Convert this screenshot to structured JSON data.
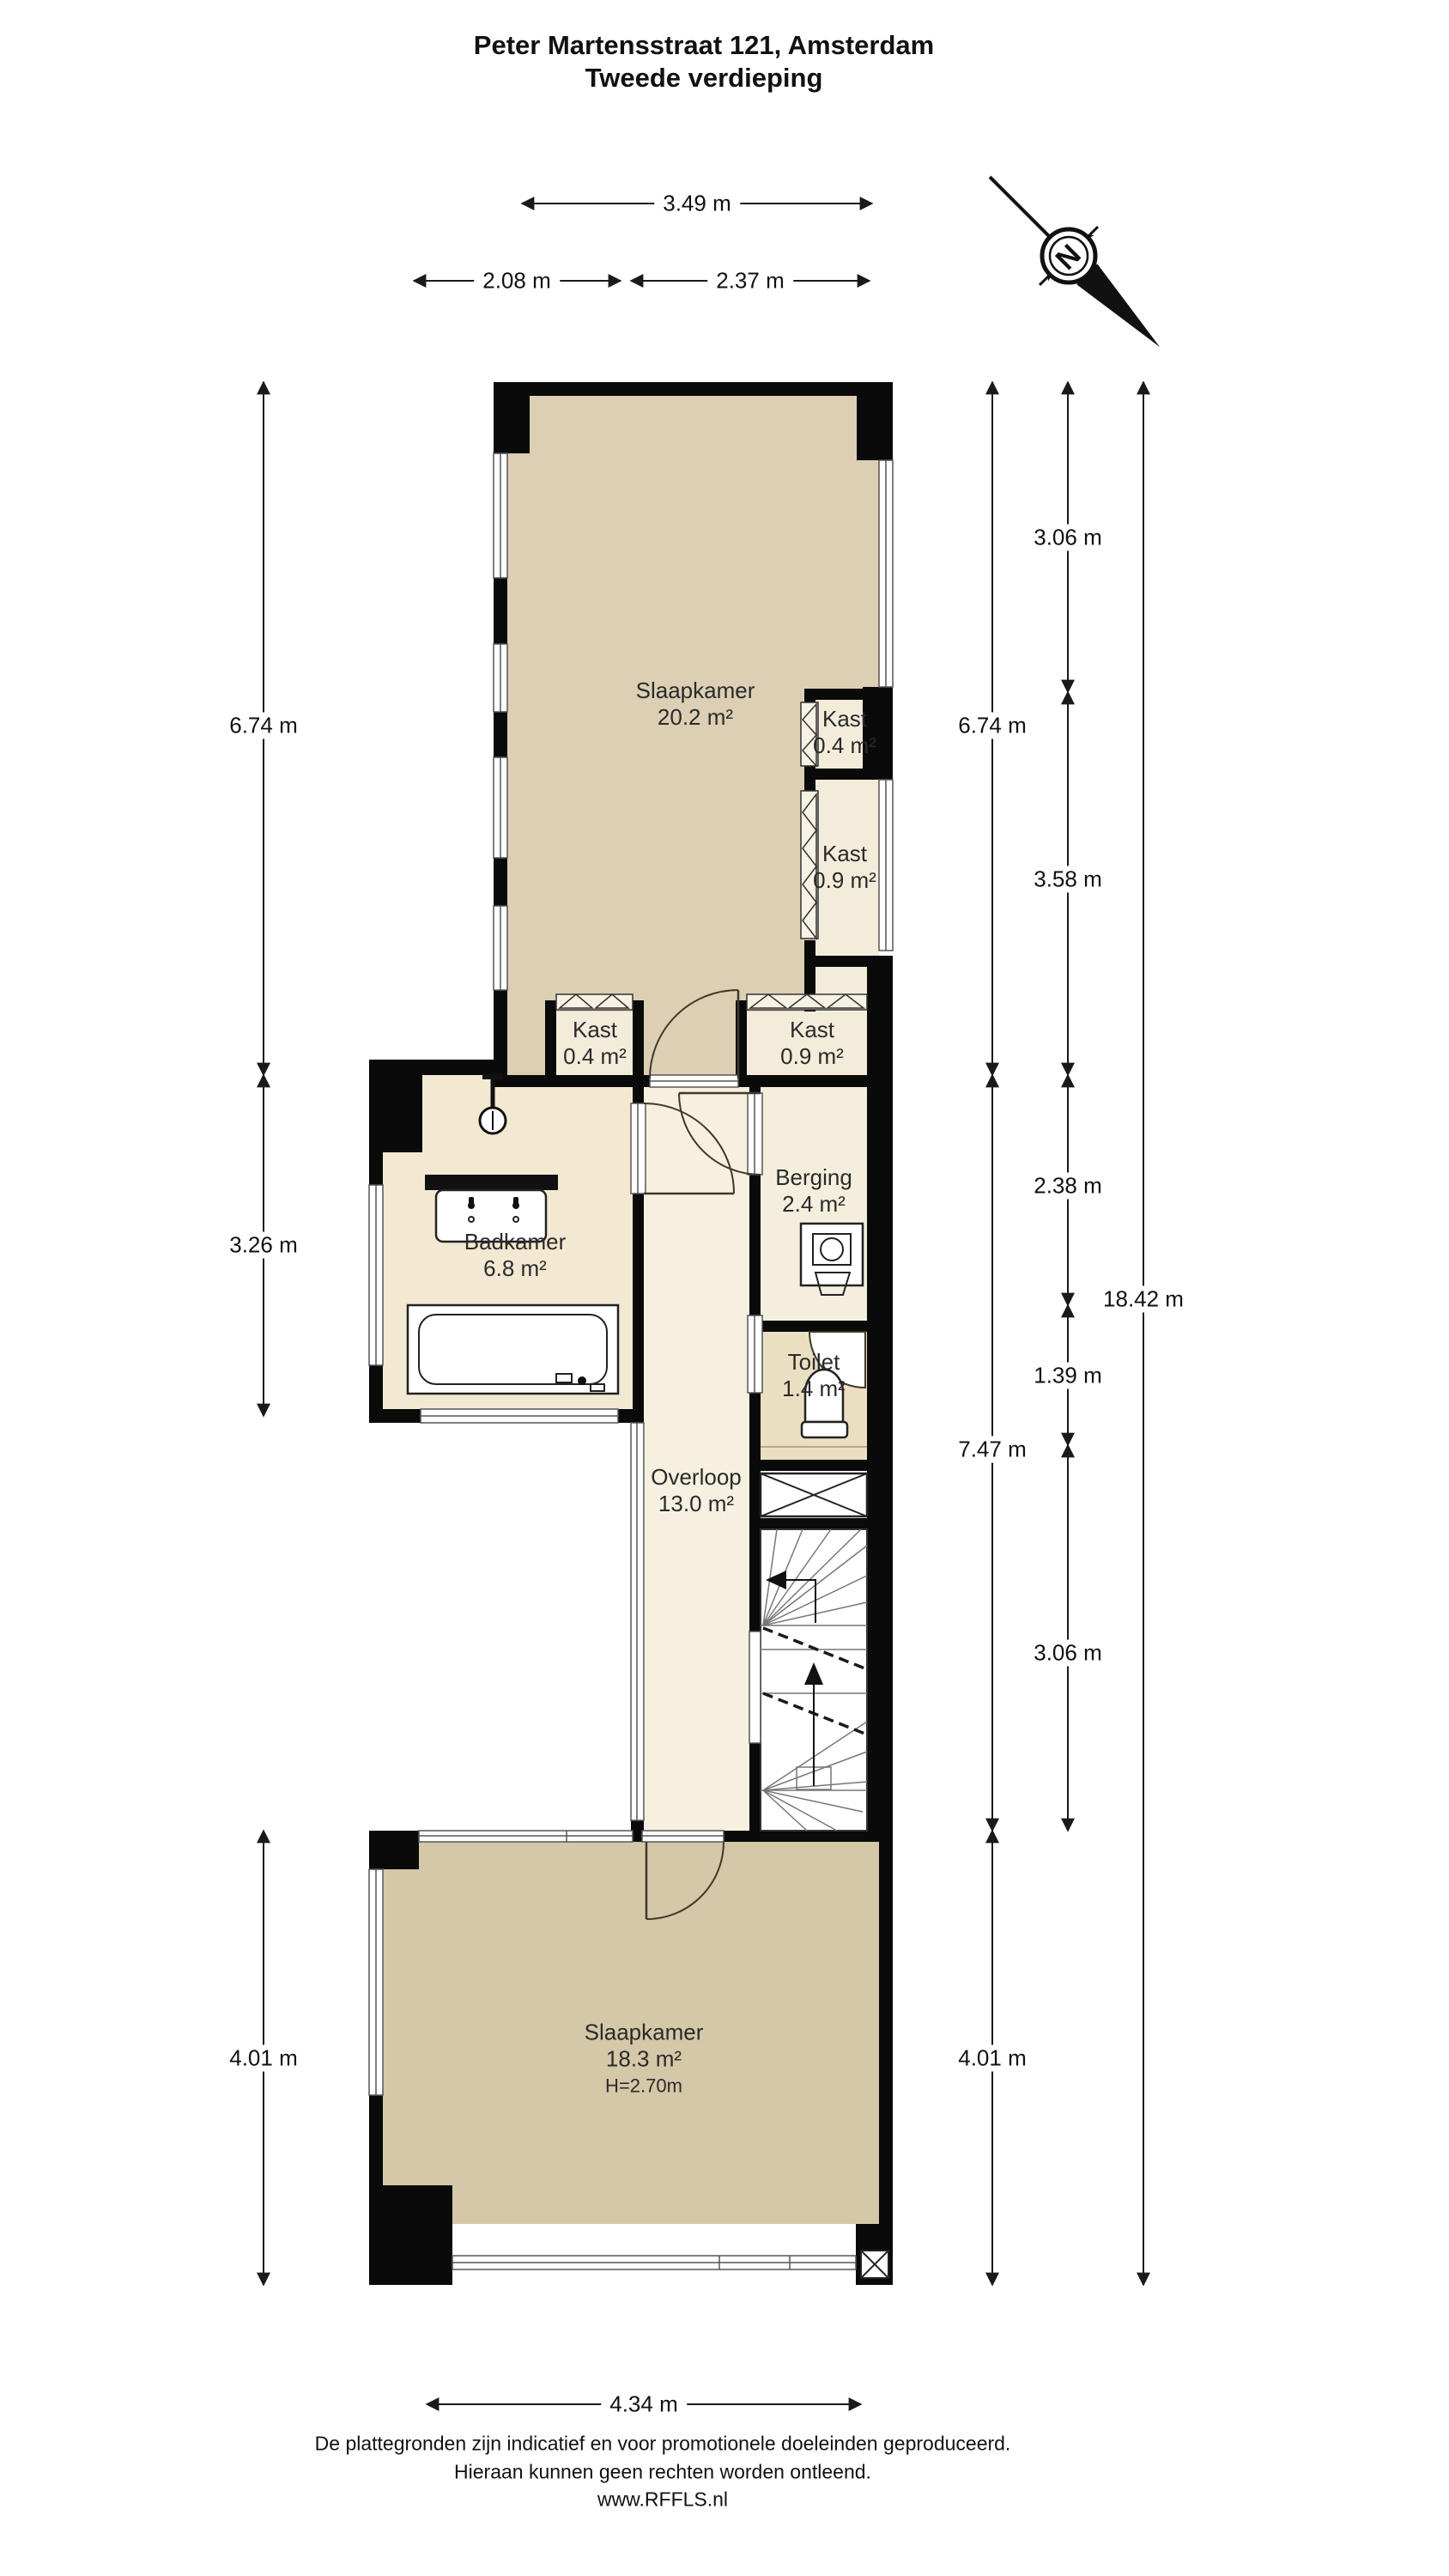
{
  "title": {
    "line1": "Peter Martensstraat 121, Amsterdam",
    "line2": "Tweede verdieping"
  },
  "compass": {
    "north_label": "N"
  },
  "rooms": {
    "slaapkamer_boven": {
      "name": "Slaapkamer",
      "area": "20.2 m²"
    },
    "kast_boven_1": {
      "name": "Kast",
      "area": "0.4 m²"
    },
    "kast_boven_2": {
      "name": "Kast",
      "area": "0.9 m²"
    },
    "kast_onder_links": {
      "name": "Kast",
      "area": "0.4 m²"
    },
    "kast_onder_rechts": {
      "name": "Kast",
      "area": "0.9 m²"
    },
    "badkamer": {
      "name": "Badkamer",
      "area": "6.8 m²"
    },
    "berging": {
      "name": "Berging",
      "area": "2.4 m²"
    },
    "toilet": {
      "name": "Toilet",
      "area": "1.4 m²"
    },
    "overloop": {
      "name": "Overloop",
      "area": "13.0 m²"
    },
    "slaapkamer_onder": {
      "name": "Slaapkamer",
      "area": "18.3 m²",
      "height": "H=2.70m"
    }
  },
  "dimensions": {
    "top_total": "3.49 m",
    "top_left": "2.08 m",
    "top_right": "2.37 m",
    "left_upper": "6.74 m",
    "left_middle": "3.26 m",
    "left_lower": "4.01 m",
    "right_inner_upper": "6.74 m",
    "right_inner_middle": "7.47 m",
    "right_inner_lower": "4.01 m",
    "right_mid_1": "3.06 m",
    "right_mid_2": "3.58 m",
    "right_mid_3": "2.38 m",
    "right_mid_4": "1.39 m",
    "right_mid_5": "3.06 m",
    "right_outer_total": "18.42 m",
    "bottom_total": "4.34 m"
  },
  "footer": {
    "line1": "De plattegronden zijn indicatief en voor promotionele doeleinden geproduceerd.",
    "line2": "Hieraan kunnen geen rechten worden ontleend.",
    "line3": "www.RFFLS.nl"
  },
  "colors": {
    "wall": "#0a0a0a",
    "bedroom_upper_fill": "#dccfb4",
    "bedroom_lower_fill": "#d5c8a8",
    "hall_fill": "#f6f0e0",
    "bathroom_fill": "#f3e9d2",
    "toilet_fill": "#ebdfc2",
    "storage_fill": "#f4eedd",
    "closet_fill": "#f3ecda"
  }
}
